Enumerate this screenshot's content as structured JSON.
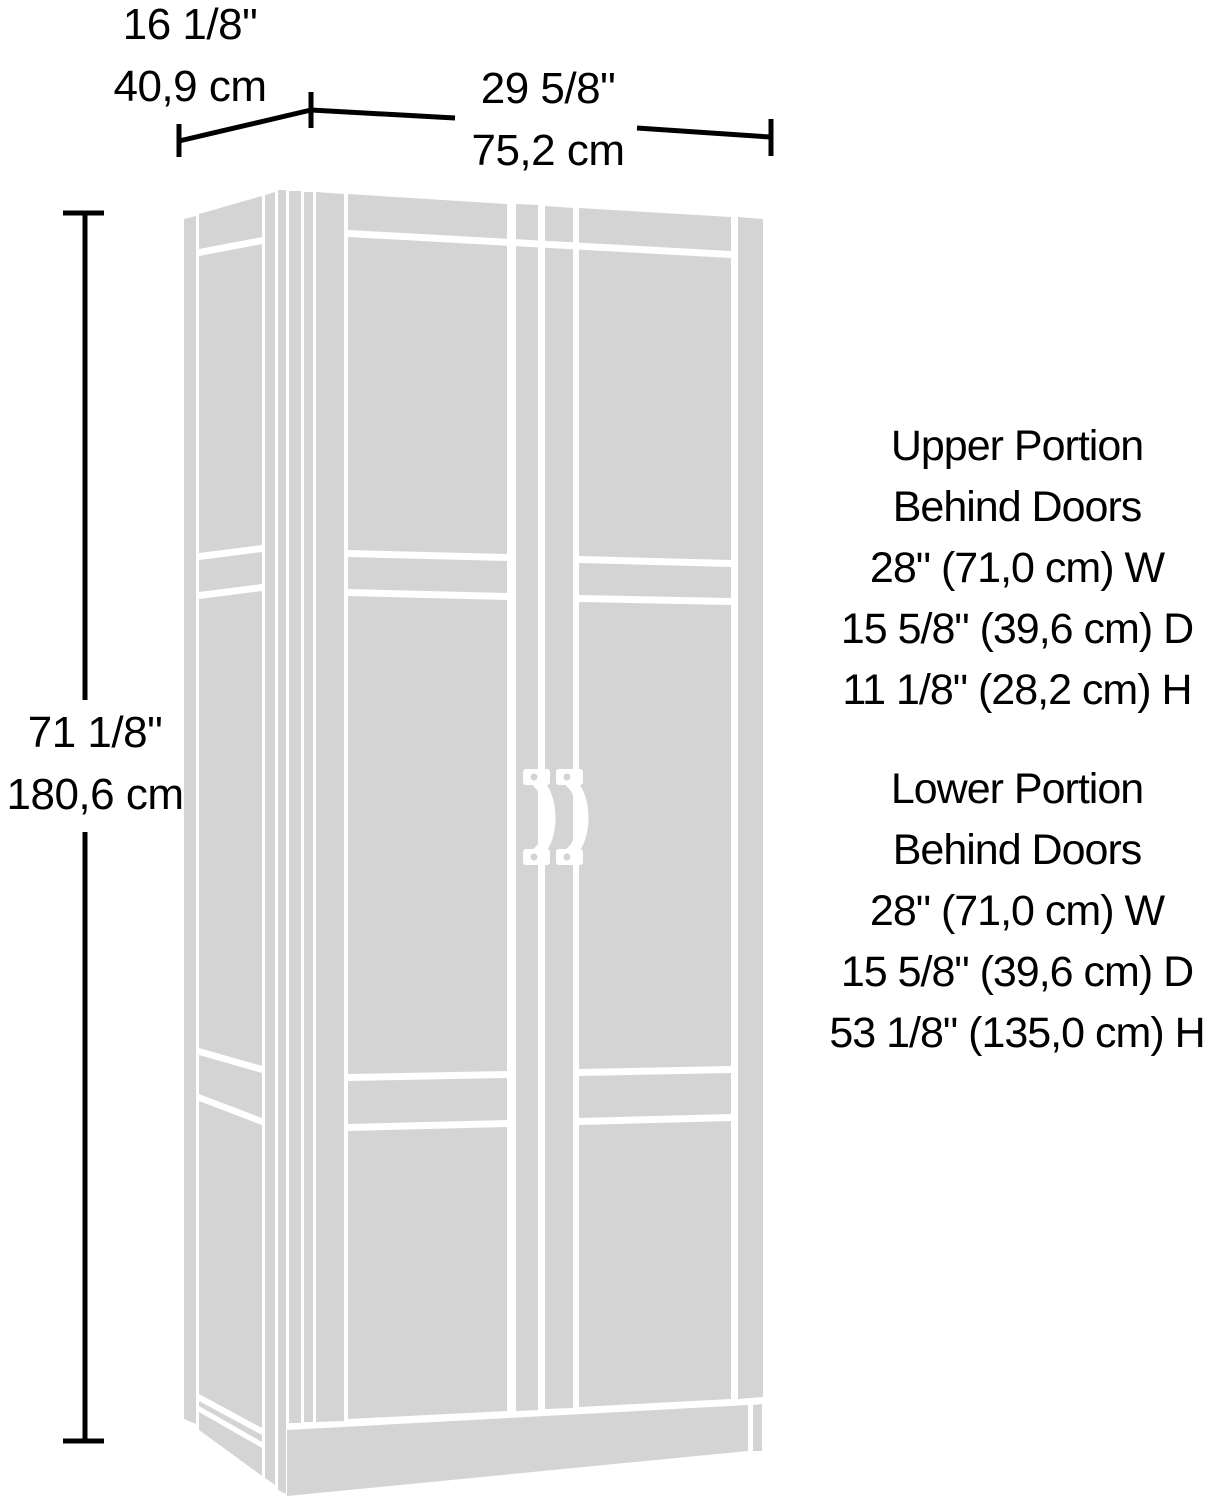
{
  "colors": {
    "cabinet_fill": "#d4d4d4",
    "line": "#000000",
    "background": "#ffffff"
  },
  "dimensions": {
    "depth": {
      "inches": "16 1/8\"",
      "metric": "40,9 cm"
    },
    "width": {
      "inches": "29 5/8\"",
      "metric": "75,2 cm"
    },
    "height": {
      "inches": "71 1/8\"",
      "metric": "180,6 cm"
    }
  },
  "annotations": {
    "upper": {
      "title_line1": "Upper Portion",
      "title_line2": "Behind Doors",
      "width_spec": "28\" (71,0 cm) W",
      "depth_spec": "15 5/8\" (39,6 cm) D",
      "height_spec": "11 1/8\" (28,2 cm) H"
    },
    "lower": {
      "title_line1": "Lower Portion",
      "title_line2": "Behind Doors",
      "width_spec": "28\" (71,0 cm) W",
      "depth_spec": "15 5/8\" (39,6 cm) D",
      "height_spec": "53 1/8\" (135,0 cm) H"
    }
  }
}
